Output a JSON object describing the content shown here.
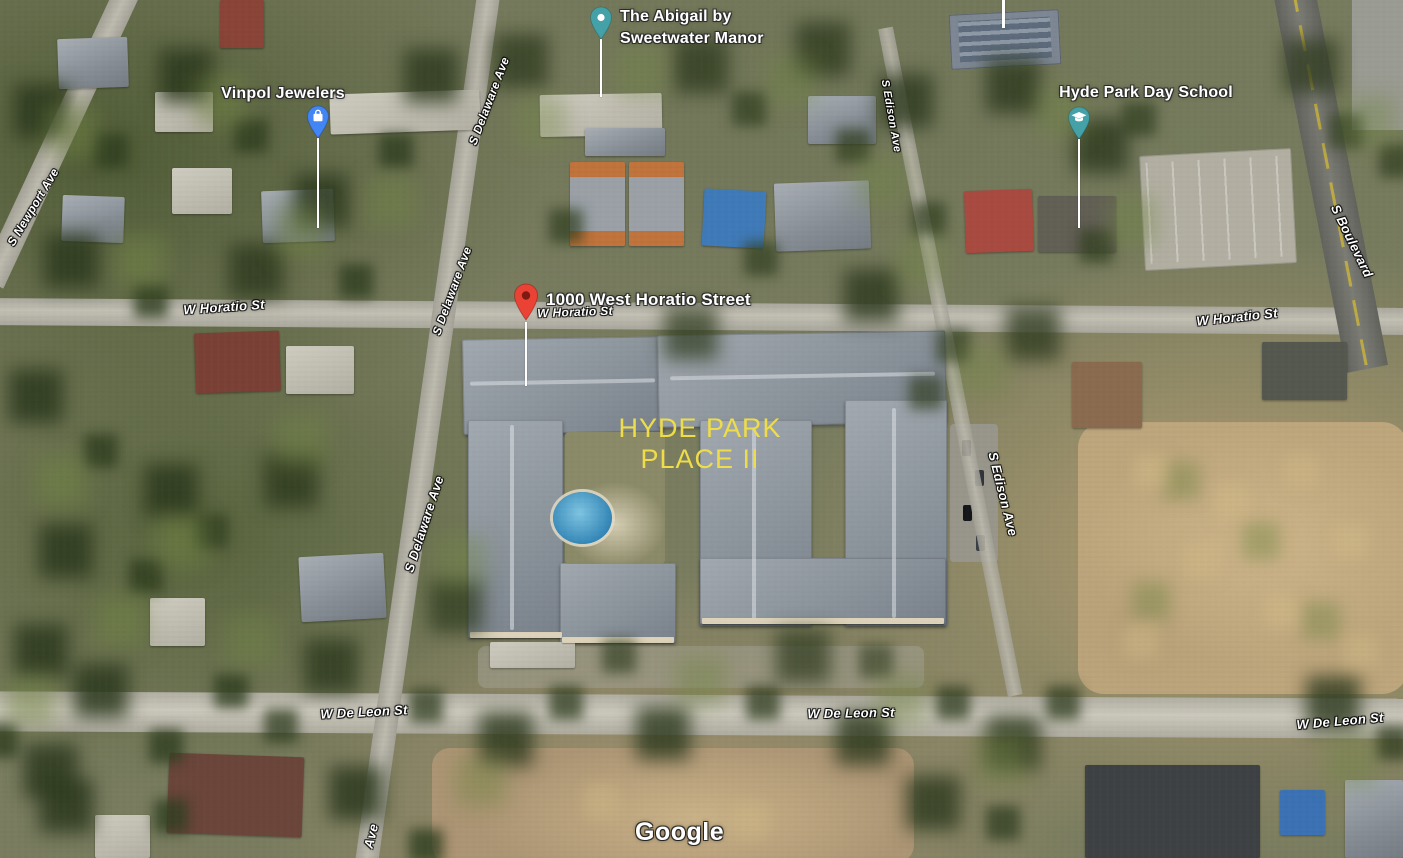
{
  "map": {
    "watermark": "Google",
    "colors": {
      "poi_pin_blue": "#4285F4",
      "poi_pin_teal": "#44A1A8",
      "address_pin_red": "#EA4335",
      "area_label_yellow": "#EEDD49",
      "street_label": "#FFFFFF"
    },
    "pois": [
      {
        "name": "Vinpol Jewelers",
        "icon": "shopping-bag-icon",
        "pin_color": "#4285F4"
      },
      {
        "name": "The Abigail by Sweetwater Manor",
        "line1": "The Abigail by",
        "line2": "Sweetwater Manor",
        "icon": "lodging-dot-icon",
        "pin_color": "#44A1A8"
      },
      {
        "name": "Hyde Park Day School",
        "icon": "graduation-cap-icon",
        "pin_color": "#44A1A8"
      }
    ],
    "address_marker": {
      "label": "1000 West Horatio Street",
      "pin_color": "#EA4335"
    },
    "area_label": {
      "line1": "HYDE PARK",
      "line2": "PLACE II"
    },
    "streets": {
      "w_horatio": "W Horatio St",
      "w_de_leon": "W De Leon St",
      "s_delaware": "S Delaware Ave",
      "s_delaware_partial": "Ave",
      "s_edison": "S Edison Ave",
      "s_newport": "S Newport Ave",
      "s_boulevard": "S Boulevard"
    }
  }
}
